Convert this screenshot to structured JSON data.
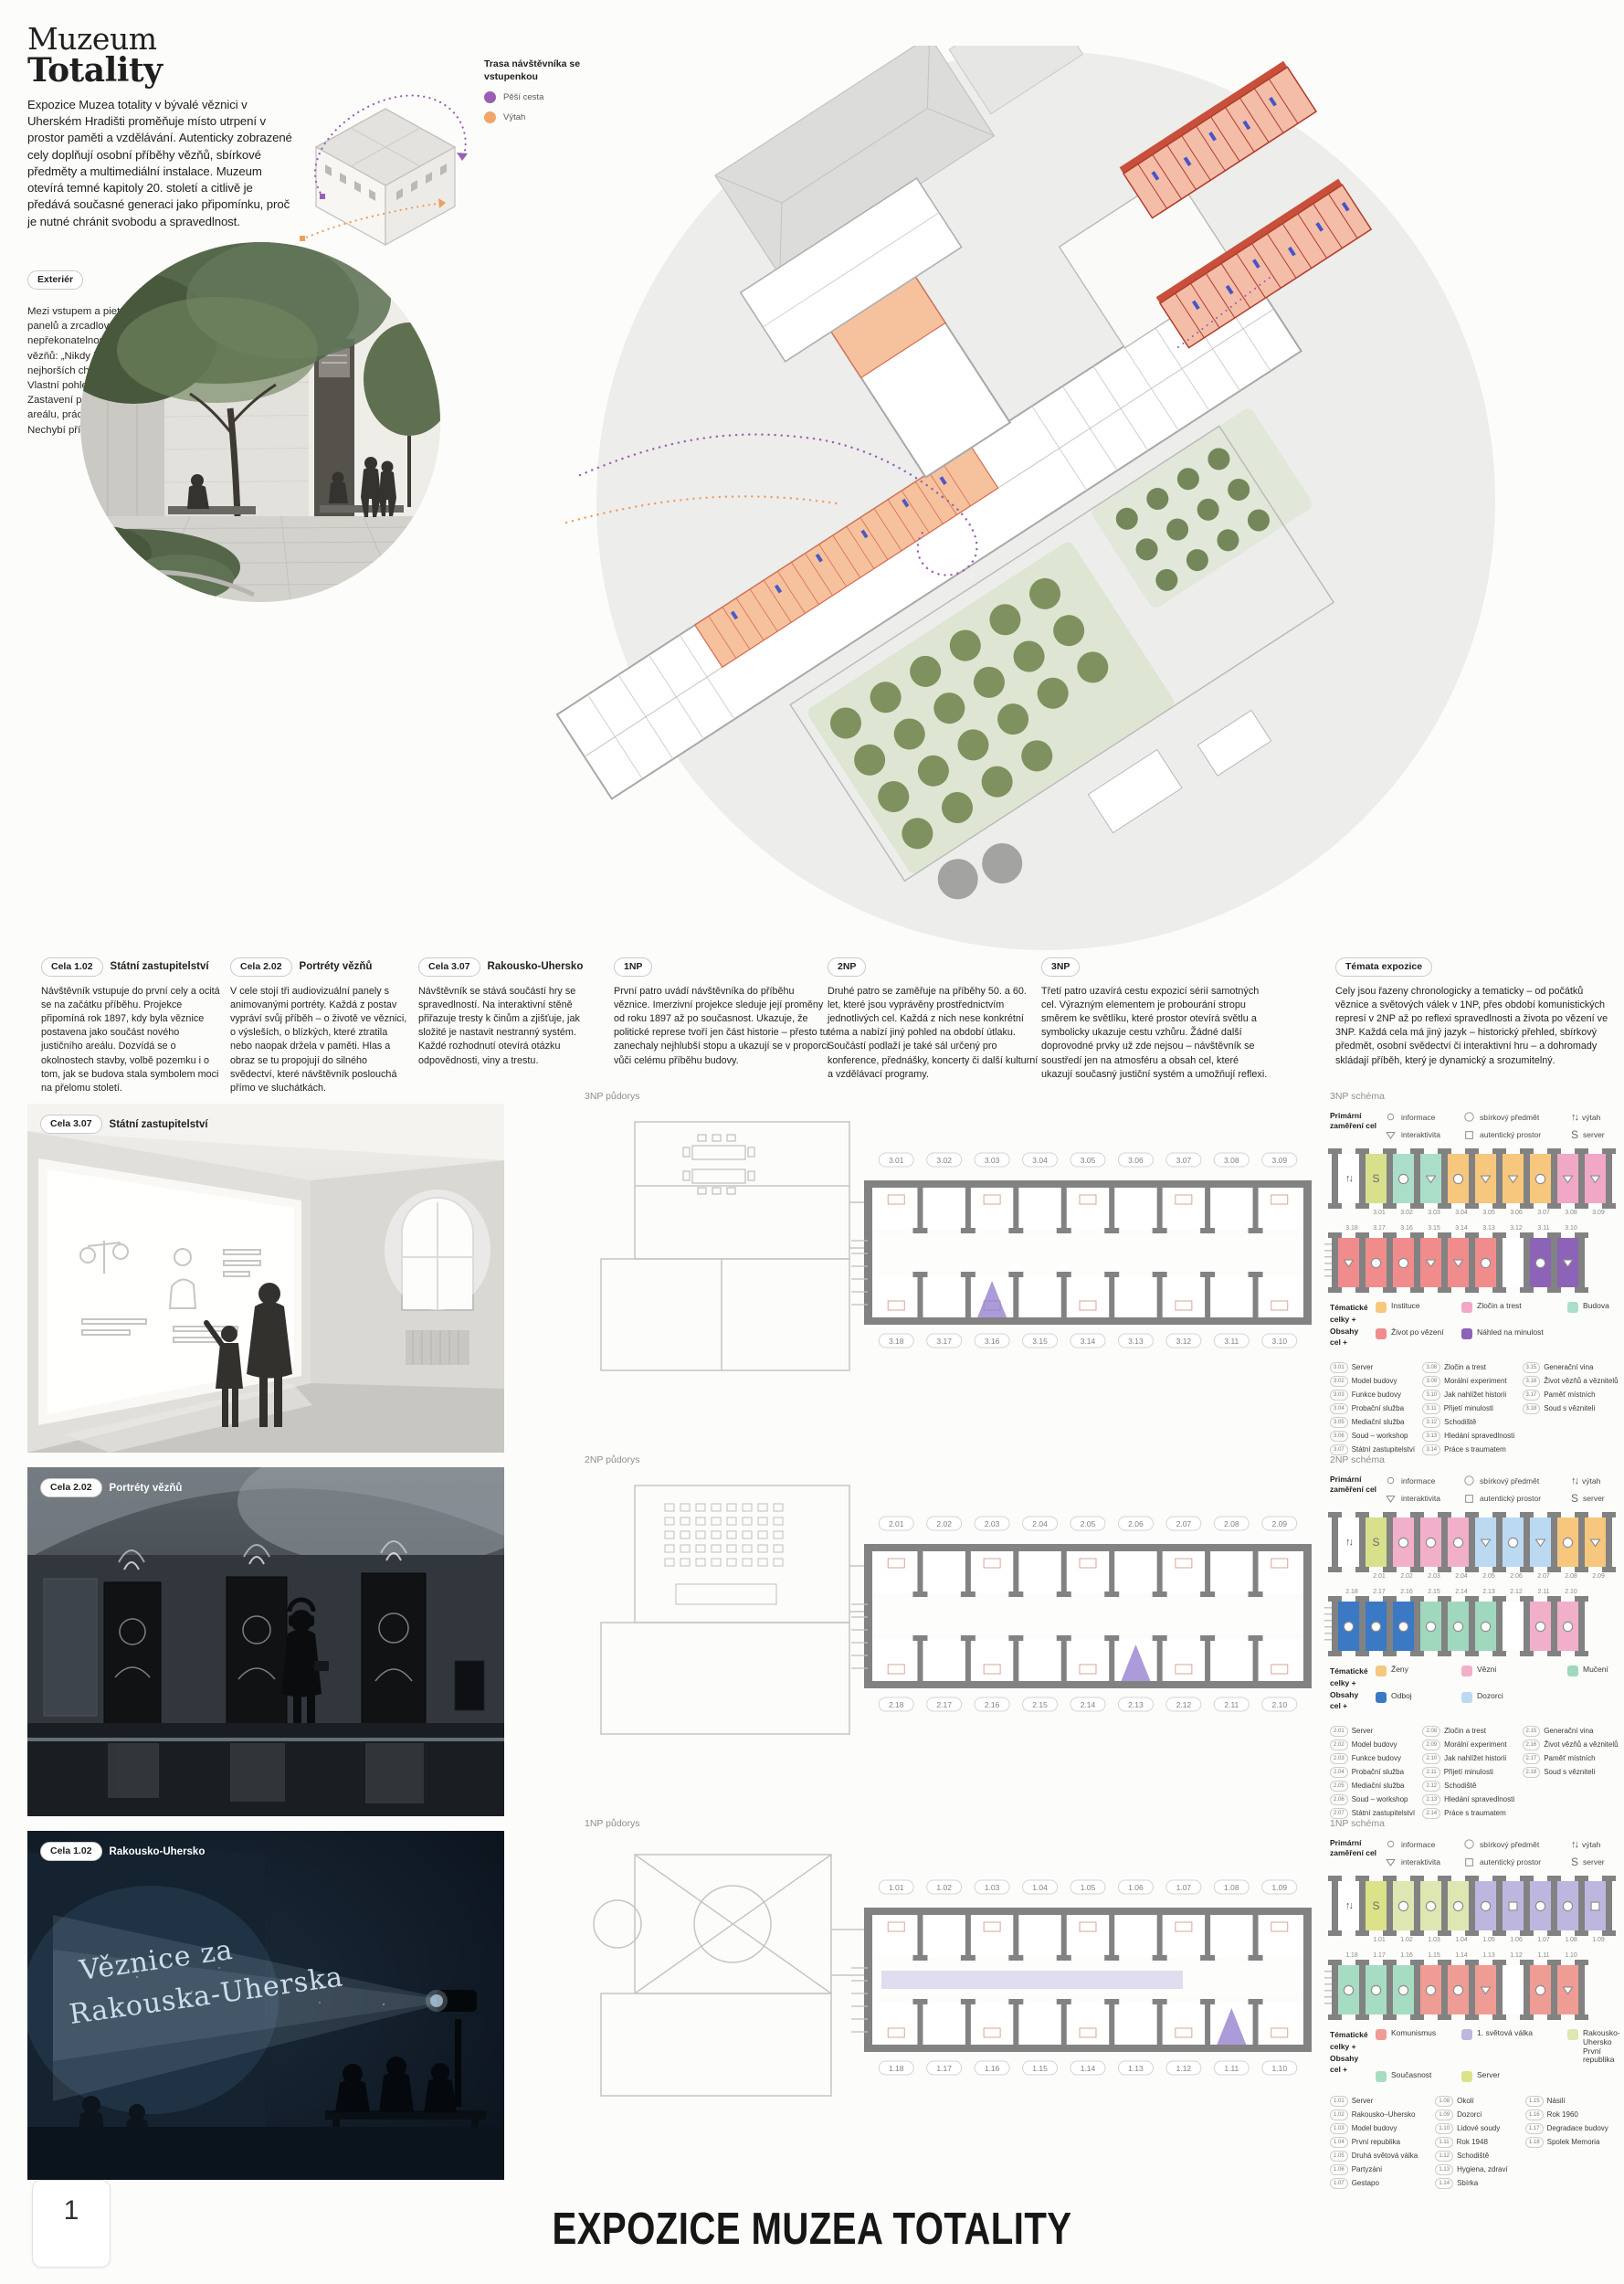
{
  "header": {
    "title_line1": "Muzeum",
    "title_line2": "Totality",
    "intro": "Expozice Muzea totality v bývalé věznici v Uherském Hradišti proměňuje místo utrpení v prostor paměti a vzdělávání. Autenticky zobrazené cely doplňují osobní příběhy vězňů, sbírkové předměty a multimediální instalace. Muzeum otevírá temné kapitoly 20. století a citlivě je předává současné generaci jako připomínku, proč je nutné chránit svobodu a spravedlnost.",
    "exterior_tag": "Exteriér",
    "exterior_text": "Mezi vstupem a pietním dvorem návštěvník prochází kolem panelů a zrcadlových ploch, které narušují nepřekonatelnost zdí. V odrazech se mísí mříže i citáty vězňů: „Nikdy jsme nevěděli, kolik je hodin.“ – „I v nejhorších chvílích jsme si vyráběli drobnosti z chleba.“ Vlastní pohled diváka se tak spojuje s pamětí místa. Zastavení připomínají stavbu věznice, fungování justičního areálu, práci vězňů, poválečné soudy i přístavby z 50. let. Nechybí příběh torza památníku hodonínské stávky."
  },
  "route_legend": {
    "title": "Trasa návštěvníka se vstupenkou",
    "items": [
      {
        "label": "Pěší cesta",
        "color": "#9A5FB5"
      },
      {
        "label": "Výtah",
        "color": "#F0A668"
      }
    ]
  },
  "colors": {
    "purple_route": "#9A5FB5",
    "orange_route": "#EF9E5C",
    "plan_orange": "#F6C29E",
    "wall_gray": "#828282"
  },
  "columns": [
    {
      "tag": "Cela 1.02",
      "label": "Státní zastupitelství",
      "text": "Návštěvník vstupuje do první cely a ocitá se na začátku příběhu. Projekce připomíná rok 1897, kdy byla věznice postavena jako součást nového justičního areálu. Dozvídá se o okolnostech stavby, volbě pozemku i o tom, jak se budova stala symbolem moci na přelomu století."
    },
    {
      "tag": "Cela 2.02",
      "label": "Portréty vězňů",
      "text": "V cele stojí tři audiovizuální panely s animovanými portréty. Každá z postav vypráví svůj příběh – o životě ve věznici, o výsleších, o blízkých, které ztratila nebo naopak držela v paměti. Hlas a obraz se tu propojují do silného svědectví, které návštěvník poslouchá přímo ve sluchátkách."
    },
    {
      "tag": "Cela 3.07",
      "label": "Rakousko-Uhersko",
      "text": "Návštěvník se stává součástí hry se spravedlností. Na interaktivní stěně přiřazuje tresty k činům a zjišťuje, jak složité je nastavit nestranný systém. Každé rozhodnutí otevírá otázku odpovědnosti, viny a trestu."
    },
    {
      "tag": "1NP",
      "label": "",
      "text": "První patro uvádí návštěvníka do příběhu věznice. Imerzivní projekce sleduje její proměny od roku 1897 až po současnost. Ukazuje, že politické represe tvoří jen část historie – přesto tu zanechaly nejhlubší stopu a ukazují se v proporci vůči celému příběhu budovy."
    },
    {
      "tag": "2NP",
      "label": "",
      "text": "Druhé patro se zaměřuje na příběhy 50. a 60. let, které jsou vyprávěny prostřednictvím jednotlivých cel. Každá z nich nese konkrétní téma a nabízí jiný pohled na období útlaku. Součástí podlaží je také sál určený pro konference, přednášky, koncerty či další kulturní a vzdělávací programy."
    },
    {
      "tag": "3NP",
      "label": "",
      "text": "Třetí patro uzavírá cestu expozicí sérií samotných cel. Výrazným elementem je probourání stropu směrem ke světlíku, které prostor otevírá světlu a symbolicky ukazuje cestu vzhůru. Žádné další doprovodné prvky už zde nejsou – návštěvník se soustředí jen na atmosféru a obsah cel, které ukazují současný justiční systém a umožňují reflexi."
    },
    {
      "tag": "Témata expozice",
      "label": "",
      "text": "Cely jsou řazeny chronologicky a tematicky – od počátků věznice a světových válek v 1NP, přes období komunistických represí v 2NP až po reflexi spravedlnosti a života po vězení ve 3NP. Každá cela má jiný jazyk – historický přehled, sbírkový předmět, osobní svědectví či interaktivní hru – a dohromady skládají příběh, který je dynamický a srozumitelný."
    }
  ],
  "primary_legend": {
    "title": "Primární zaměření cel",
    "items": [
      {
        "icon": "info",
        "label": "informace"
      },
      {
        "icon": "triangle",
        "label": "interaktivita"
      },
      {
        "icon": "bigcircle",
        "label": "sbírkový předmět"
      },
      {
        "icon": "square",
        "label": "autentický prostor"
      },
      {
        "icon": "lift",
        "label": "výtah"
      },
      {
        "icon": "server",
        "label": "server"
      }
    ]
  },
  "floors": [
    {
      "render_tag": "Cela 3.07",
      "render_label": "Státní zastupitelství",
      "plan_title": "3NP půdorys",
      "schema_title": "3NP schéma",
      "plan_top": [
        "3.01",
        "3.02",
        "3.03",
        "3.04",
        "3.05",
        "3.06",
        "3.07",
        "3.08",
        "3.09"
      ],
      "plan_bottom": [
        "3.18",
        "3.17",
        "3.16",
        "3.15",
        "3.14",
        "3.13",
        "3.12",
        "3.11",
        "3.10"
      ],
      "upper": [
        {
          "n": "",
          "t": "lift",
          "c": "#FFFFFF"
        },
        {
          "n": "3.01",
          "t": "server",
          "c": "#D8E08C"
        },
        {
          "n": "3.02",
          "t": "circle",
          "c": "#ABDEC8"
        },
        {
          "n": "3.03",
          "t": "triangle",
          "c": "#ABDEC8"
        },
        {
          "n": "3.04",
          "t": "circle",
          "c": "#F6C77C"
        },
        {
          "n": "3.05",
          "t": "triangle",
          "c": "#F6C77C"
        },
        {
          "n": "3.06",
          "t": "triangle",
          "c": "#F6C77C"
        },
        {
          "n": "3.07",
          "t": "circle",
          "c": "#F6C77C"
        },
        {
          "n": "3.08",
          "t": "triangle",
          "c": "#F0A8C6"
        },
        {
          "n": "3.09",
          "t": "triangle",
          "c": "#F0A8C6"
        }
      ],
      "lower": [
        {
          "n": "3.18",
          "t": "triangle",
          "c": "#F08C8C"
        },
        {
          "n": "3.17",
          "t": "circle",
          "c": "#F08C8C"
        },
        {
          "n": "3.16",
          "t": "circle",
          "c": "#F08C8C"
        },
        {
          "n": "3.15",
          "t": "triangle",
          "c": "#F08C8C"
        },
        {
          "n": "3.14",
          "t": "triangle",
          "c": "#F08C8C"
        },
        {
          "n": "3.13",
          "t": "circle",
          "c": "#F08C8C"
        },
        {
          "n": "3.12",
          "t": "stair",
          "c": "#FFFFFF"
        },
        {
          "n": "3.11",
          "t": "circle",
          "c": "#8C63B6"
        },
        {
          "n": "3.10",
          "t": "triangle",
          "c": "#8C63B6"
        }
      ],
      "themes_label_1": "Tématické celky +",
      "themes_label_2": "Obsahy cel +",
      "themes": [
        {
          "label": "Instituce",
          "color": "#F6C77C"
        },
        {
          "label": "Zločin a trest",
          "color": "#F0A8C6"
        },
        {
          "label": "Budova",
          "color": "#ABDEC8"
        },
        {
          "label": "Život po vězení",
          "color": "#F08C8C"
        },
        {
          "label": "Náhled na minulost",
          "color": "#8C63B6"
        }
      ],
      "cells": [
        [
          "3.01",
          "Server"
        ],
        [
          "3.02",
          "Model budovy"
        ],
        [
          "3.03",
          "Funkce budovy"
        ],
        [
          "3.04",
          "Probační služba"
        ],
        [
          "3.05",
          "Mediační služba"
        ],
        [
          "3.06",
          "Soud – workshop"
        ],
        [
          "3.07",
          "Státní zastupitelství"
        ],
        [
          "3.08",
          "Zločin a trest"
        ],
        [
          "3.09",
          "Morální experiment"
        ],
        [
          "3.10",
          "Jak nahlížet historii"
        ],
        [
          "3.11",
          "Přijetí minulosti"
        ],
        [
          "3.12",
          "Schodiště"
        ],
        [
          "3.13",
          "Hledání spravedlnosti"
        ],
        [
          "3.14",
          "Práce s traumatem"
        ],
        [
          "3.15",
          "Generační vina"
        ],
        [
          "3.16",
          "Život vězňů a věznitelů"
        ],
        [
          "3.17",
          "Paměť místních"
        ],
        [
          "3.18",
          "Soud s vězniteli"
        ]
      ]
    },
    {
      "render_tag": "Cela 2.02",
      "render_label": "Portréty vězňů",
      "plan_title": "2NP půdorys",
      "schema_title": "2NP schéma",
      "plan_top": [
        "2.01",
        "2.02",
        "2.03",
        "2.04",
        "2.05",
        "2.06",
        "2.07",
        "2.08",
        "2.09"
      ],
      "plan_bottom": [
        "2.18",
        "2.17",
        "2.16",
        "2.15",
        "2.14",
        "2.13",
        "2.12",
        "2.11",
        "2.10"
      ],
      "upper": [
        {
          "n": "",
          "t": "lift",
          "c": "#FFFFFF"
        },
        {
          "n": "2.01",
          "t": "server",
          "c": "#D8E08C"
        },
        {
          "n": "2.02",
          "t": "circle",
          "c": "#F2AFC9"
        },
        {
          "n": "2.03",
          "t": "circle",
          "c": "#F2AFC9"
        },
        {
          "n": "2.04",
          "t": "circle",
          "c": "#F2AFC9"
        },
        {
          "n": "2.05",
          "t": "triangle",
          "c": "#BCD9F2"
        },
        {
          "n": "2.06",
          "t": "circle",
          "c": "#BCD9F2"
        },
        {
          "n": "2.07",
          "t": "triangle",
          "c": "#BCD9F2"
        },
        {
          "n": "2.08",
          "t": "circle",
          "c": "#F6C77C"
        },
        {
          "n": "2.09",
          "t": "triangle",
          "c": "#F6C77C"
        }
      ],
      "lower": [
        {
          "n": "2.18",
          "t": "circle",
          "c": "#3B79C4"
        },
        {
          "n": "2.17",
          "t": "circle",
          "c": "#3B79C4"
        },
        {
          "n": "2.16",
          "t": "circle",
          "c": "#3B79C4"
        },
        {
          "n": "2.15",
          "t": "circle",
          "c": "#A0D8BD"
        },
        {
          "n": "2.14",
          "t": "circle",
          "c": "#A0D8BD"
        },
        {
          "n": "2.13",
          "t": "circle",
          "c": "#A0D8BD"
        },
        {
          "n": "2.12",
          "t": "stair",
          "c": "#FFFFFF"
        },
        {
          "n": "2.11",
          "t": "circle",
          "c": "#F2AFC9"
        },
        {
          "n": "2.10",
          "t": "circle",
          "c": "#F2AFC9"
        }
      ],
      "themes_label_1": "Tématické celky +",
      "themes_label_2": "Obsahy cel +",
      "themes": [
        {
          "label": "Ženy",
          "color": "#F6C77C"
        },
        {
          "label": "Vězni",
          "color": "#F2AFC9"
        },
        {
          "label": "Mučení",
          "color": "#A0D8BD"
        },
        {
          "label": "Odboj",
          "color": "#3B79C4"
        },
        {
          "label": "Dozorci",
          "color": "#BCD9F2"
        }
      ],
      "cells": [
        [
          "2.01",
          "Server"
        ],
        [
          "2.02",
          "Model budovy"
        ],
        [
          "2.03",
          "Funkce budovy"
        ],
        [
          "2.04",
          "Probační služba"
        ],
        [
          "2.05",
          "Mediační služba"
        ],
        [
          "2.06",
          "Soud – workshop"
        ],
        [
          "2.07",
          "Státní zastupitelství"
        ],
        [
          "2.08",
          "Zločin a trest"
        ],
        [
          "2.09",
          "Morální experiment"
        ],
        [
          "2.10",
          "Jak nahlížet historii"
        ],
        [
          "2.11",
          "Přijetí minulosti"
        ],
        [
          "2.12",
          "Schodiště"
        ],
        [
          "2.13",
          "Hledání spravedlnosti"
        ],
        [
          "2.14",
          "Práce s traumatem"
        ],
        [
          "2.15",
          "Generační vina"
        ],
        [
          "2.16",
          "Život vězňů a věznitelů"
        ],
        [
          "2.17",
          "Paměť místních"
        ],
        [
          "2.18",
          "Soud s vězniteli"
        ]
      ]
    },
    {
      "render_tag": "Cela 1.02",
      "render_label": "Rakousko-Uhersko",
      "render_text1": "Věznice za",
      "render_text2": "Rakouska-Uherska",
      "plan_title": "1NP půdorys",
      "schema_title": "1NP schéma",
      "plan_top": [
        "1.01",
        "1.02",
        "1.03",
        "1.04",
        "1.05",
        "1.06",
        "1.07",
        "1.08",
        "1.09"
      ],
      "plan_bottom": [
        "1.18",
        "1.17",
        "1.16",
        "1.15",
        "1.14",
        "1.13",
        "1.12",
        "1.11",
        "1.10"
      ],
      "upper": [
        {
          "n": "",
          "t": "lift",
          "c": "#FFFFFF"
        },
        {
          "n": "1.01",
          "t": "server",
          "c": "#DCE287"
        },
        {
          "n": "1.02",
          "t": "circle",
          "c": "#DEE6B2"
        },
        {
          "n": "1.03",
          "t": "circle",
          "c": "#DEE6B2"
        },
        {
          "n": "1.04",
          "t": "circle",
          "c": "#DEE6B2"
        },
        {
          "n": "1.05",
          "t": "circle",
          "c": "#BDB7E0"
        },
        {
          "n": "1.06",
          "t": "square",
          "c": "#BDB7E0"
        },
        {
          "n": "1.07",
          "t": "circle",
          "c": "#BDB7E0"
        },
        {
          "n": "1.08",
          "t": "circle",
          "c": "#BDB7E0"
        },
        {
          "n": "1.09",
          "t": "square",
          "c": "#BDB7E0"
        }
      ],
      "lower": [
        {
          "n": "1.18",
          "t": "circle",
          "c": "#A6DCC2"
        },
        {
          "n": "1.17",
          "t": "circle",
          "c": "#A6DCC2"
        },
        {
          "n": "1.16",
          "t": "circle",
          "c": "#A6DCC2"
        },
        {
          "n": "1.15",
          "t": "circle",
          "c": "#EF9C94"
        },
        {
          "n": "1.14",
          "t": "circle",
          "c": "#EF9C94"
        },
        {
          "n": "1.13",
          "t": "triangle",
          "c": "#EF9C94"
        },
        {
          "n": "1.12",
          "t": "stair",
          "c": "#FFFFFF"
        },
        {
          "n": "1.11",
          "t": "circle",
          "c": "#EF9C94"
        },
        {
          "n": "1.10",
          "t": "triangle",
          "c": "#EF9C94"
        }
      ],
      "themes_label_1": "Tématické celky +",
      "themes_label_2": "Obsahy cel +",
      "themes": [
        {
          "label": "Komunismus",
          "color": "#EF9C94"
        },
        {
          "label": "1. světová válka",
          "color": "#BDB7E0"
        },
        {
          "label": "Rakousko-Uhersko První republika",
          "color": "#DEE6B2"
        },
        {
          "label": "Současnost",
          "color": "#A6DCC2"
        },
        {
          "label": "Server",
          "color": "#DCE287"
        }
      ],
      "cells": [
        [
          "1.01",
          "Server"
        ],
        [
          "1.02",
          "Rakousko–Uhersko"
        ],
        [
          "1.03",
          "Model budovy"
        ],
        [
          "1.04",
          "První republika"
        ],
        [
          "1.05",
          "Druhá světová válka"
        ],
        [
          "1.06",
          "Partyzáni"
        ],
        [
          "1.07",
          "Gestapo"
        ],
        [
          "1.08",
          "Okolí"
        ],
        [
          "1.09",
          "Dozorci"
        ],
        [
          "1.10",
          "Lidové soudy"
        ],
        [
          "1.11",
          "Rok 1948"
        ],
        [
          "1.12",
          "Schodiště"
        ],
        [
          "1.13",
          "Hygiena, zdraví"
        ],
        [
          "1.14",
          "Sbírka"
        ],
        [
          "1.15",
          "Násilí"
        ],
        [
          "1.16",
          "Rok 1960"
        ],
        [
          "1.17",
          "Degradace budovy"
        ],
        [
          "1.18",
          "Spolek Memoria"
        ]
      ]
    }
  ],
  "footer": {
    "page_number": "1",
    "title": "EXPOZICE MUZEA TOTALITY"
  }
}
